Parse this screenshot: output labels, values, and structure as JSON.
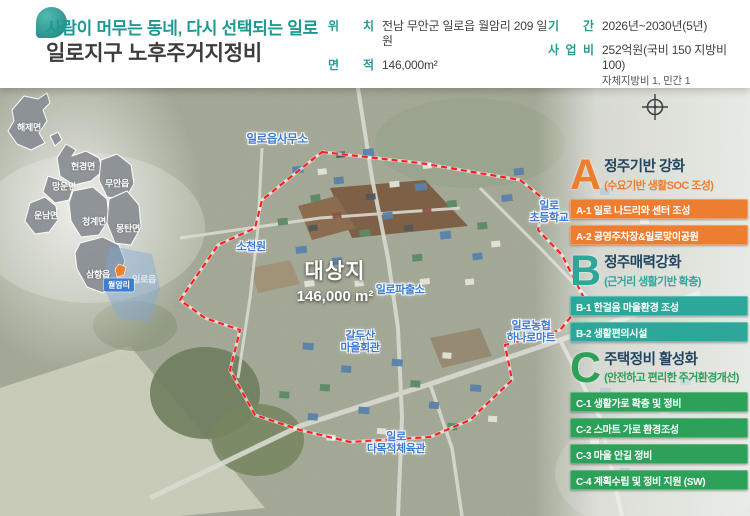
{
  "header": {
    "slogan": "사람이 머무는 동네, 다시 선택되는 일로",
    "title": "일로지구 노후주거지정비",
    "info": [
      {
        "label": "위 치",
        "value": "전남 무안군 일로읍 월암리 209 일원"
      },
      {
        "label": "면 적",
        "value": "146,000m²"
      },
      {
        "label": "기 간",
        "value": "2026년~2030년(5년)"
      },
      {
        "label": "사 업 비",
        "value": "252억원(국비 150 지방비 100)",
        "value2": "자체지방비 1, 민간 1"
      }
    ]
  },
  "inset": {
    "regions": [
      {
        "name": "해제면"
      },
      {
        "name": "현경면"
      },
      {
        "name": "망운면"
      },
      {
        "name": "무안읍"
      },
      {
        "name": "운남면"
      },
      {
        "name": "청계면"
      },
      {
        "name": "몽탄면"
      },
      {
        "name": "삼향읍"
      },
      {
        "name": "일로읍"
      }
    ],
    "marker_label": "월암리"
  },
  "map": {
    "target": {
      "name": "대상지",
      "area": "146,000 m²"
    },
    "pois": [
      {
        "label": "일로읍사무소"
      },
      {
        "label": "소천원"
      },
      {
        "label": "일로\n초등학교"
      },
      {
        "label": "일로파출소"
      },
      {
        "label": "갈두산\n마을회관"
      },
      {
        "label": "일로농협\n하나로마트"
      },
      {
        "label": "일로\n다목적체육관"
      }
    ]
  },
  "panels": [
    {
      "letter": "A",
      "title": "정주기반 강화",
      "subtitle": "(수요기반 생활SOC 조성)",
      "color": "#ed7d31",
      "items": [
        "A-1 일로 나드리와 센터 조성",
        "A-2 공영주차장&일로맞이공원"
      ]
    },
    {
      "letter": "B",
      "title": "정주매력강화",
      "subtitle": "(근거리 생활기반 확충)",
      "color": "#2ea79b",
      "items": [
        "B-1 한걸음 마을환경 조성",
        "B-2 생활편의시설"
      ]
    },
    {
      "letter": "C",
      "title": "주택정비 활성화",
      "subtitle": "(안전하고 편리한 주거환경개선)",
      "color": "#2da05a",
      "items": [
        "C-1 생활가로 확충 및 정비",
        "C-2 스마트 가로 환경조성",
        "C-3 마을 안길 정비",
        "C-4 계획수립 및 정비 지원 (SW)"
      ]
    }
  ],
  "colors": {
    "slogan_teal": "#1c9a92",
    "title_dark": "#3d3d3d",
    "label_teal": "#279c93",
    "panel_title_navy": "#22445e",
    "boundary_red": "#ff2121",
    "poi_blue": "#3d79cf",
    "badge_blue": "#3e7ed2",
    "marker_orange": "#f0832a"
  }
}
